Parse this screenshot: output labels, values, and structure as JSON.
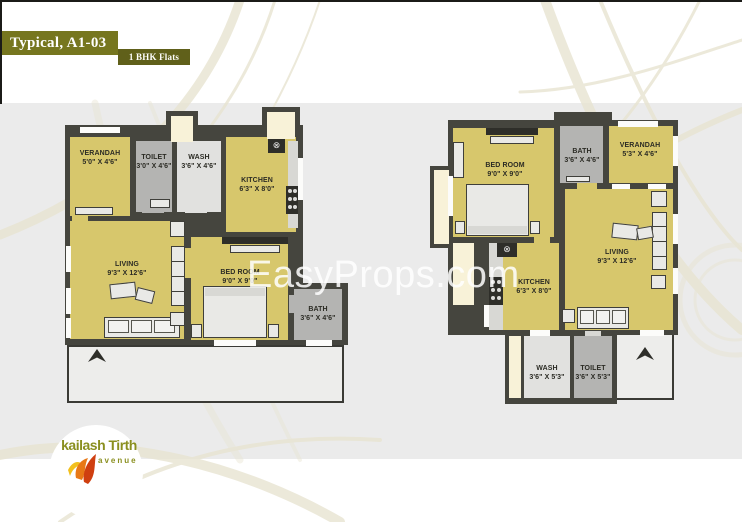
{
  "header": {
    "title": "Typical, A1-03",
    "subtitle": "1 BHK Flats"
  },
  "watermark": "EasyProps.com",
  "logo": {
    "name": "kailash Tirth",
    "tagline": "avenue"
  },
  "icons": {
    "exhaust": "⊗"
  },
  "colors": {
    "room_fill": "#d7c76c",
    "wall": "#45453e",
    "bath_gray": "#b4b4b2",
    "wash_gray": "#e1e1df",
    "duct_cream": "#f8f2d8",
    "canvas": "#ebebeb",
    "header_olive": "#76761f",
    "badge_olive": "#60601a",
    "logo_green": "#8a8f1f",
    "flame_orange": "#e87816"
  },
  "plans": [
    {
      "id": "left-flat",
      "rooms": [
        {
          "name": "VERANDAH",
          "dims": "5'0\" X 4'6\""
        },
        {
          "name": "TOILET",
          "dims": "3'0\" X 4'6\""
        },
        {
          "name": "WASH",
          "dims": "3'6\" X 4'6\""
        },
        {
          "name": "KITCHEN",
          "dims": "6'3\" X 8'0\""
        },
        {
          "name": "LIVING",
          "dims": "9'3\" X 12'6\""
        },
        {
          "name": "BED ROOM",
          "dims": "9'0\" X 9'0\""
        },
        {
          "name": "BATH",
          "dims": "3'6\" X 4'6\""
        }
      ]
    },
    {
      "id": "right-flat",
      "rooms": [
        {
          "name": "BED ROOM",
          "dims": "9'0\" X 9'0\""
        },
        {
          "name": "BATH",
          "dims": "3'6\" X 4'6\""
        },
        {
          "name": "VERANDAH",
          "dims": "5'3\" X 4'6\""
        },
        {
          "name": "LIVING",
          "dims": "9'3\" X 12'6\""
        },
        {
          "name": "KITCHEN",
          "dims": "6'3\" X 8'0\""
        },
        {
          "name": "WASH",
          "dims": "3'6\" X 5'3\""
        },
        {
          "name": "TOILET",
          "dims": "3'6\" X 5'3\""
        }
      ]
    }
  ]
}
